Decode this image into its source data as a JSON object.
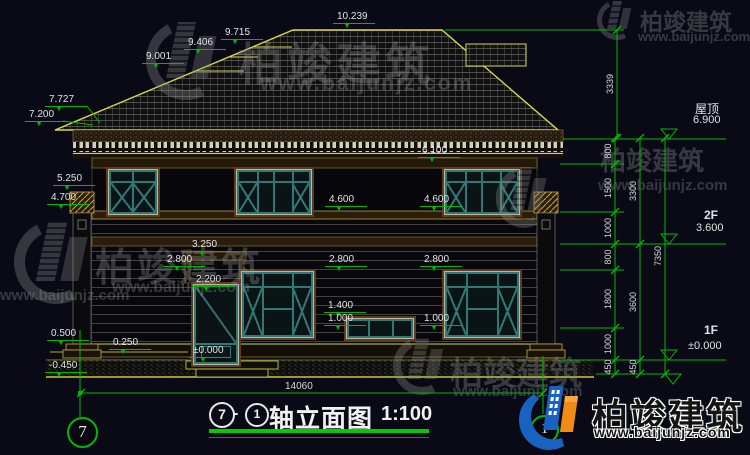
{
  "colors": {
    "background": "#0a0a16",
    "annotation_green": "#00b800",
    "outline_yellow": "#d8d848",
    "frame_teal": "#2e7878",
    "frame_brown": "#5f3d1c",
    "text_white": "#e2e2e2",
    "logo_blue": "#1862c2",
    "logo_orange": "#f08c14"
  },
  "watermark": {
    "brand": "柏竣建筑",
    "url": "www.baijunjz.com"
  },
  "logo": {
    "brand": "柏竣建筑",
    "url": "www.baijunjz.com"
  },
  "title": {
    "axis_from": "7",
    "dash": "-",
    "axis_to": "1",
    "name": "轴立面图",
    "scale": "1:100"
  },
  "axes": {
    "left_bubble": "7",
    "right_bubble": "1"
  },
  "levels": {
    "l10239": "10.239",
    "l9715": "9.715",
    "l9406": "9.406",
    "l9001": "9.001",
    "l7727": "7.727",
    "l7200": "7.200",
    "l6100": "6.100",
    "l5250": "5.250",
    "l4700": "4.700",
    "l4600a": "4.600",
    "l4600b": "4.600",
    "l3250": "3.250",
    "l2800a": "2.800",
    "l2800b": "2.800",
    "l2800c": "2.800",
    "l2200": "2.200",
    "l1400": "1.400",
    "l1000a": "1.000",
    "l1000b": "1.000",
    "l0500": "0.500",
    "l0250": "0.250",
    "l0000": "±0.000",
    "ln0450": "-0.450"
  },
  "right_markers": {
    "roof_label": "屋顶",
    "roof_value": "6.900",
    "floor2_label": "2F",
    "floor2_value": "3.600",
    "floor1_label": "1F",
    "floor1_value": "±0.000"
  },
  "dims": {
    "roof_height": "3339",
    "chain_inner": [
      "800",
      "1500",
      "1000",
      "800",
      "1800",
      "1000",
      "450"
    ],
    "chain_mid": [
      "3300",
      "3600",
      "450"
    ],
    "chain_outer": "7350",
    "total_width": "14060"
  }
}
